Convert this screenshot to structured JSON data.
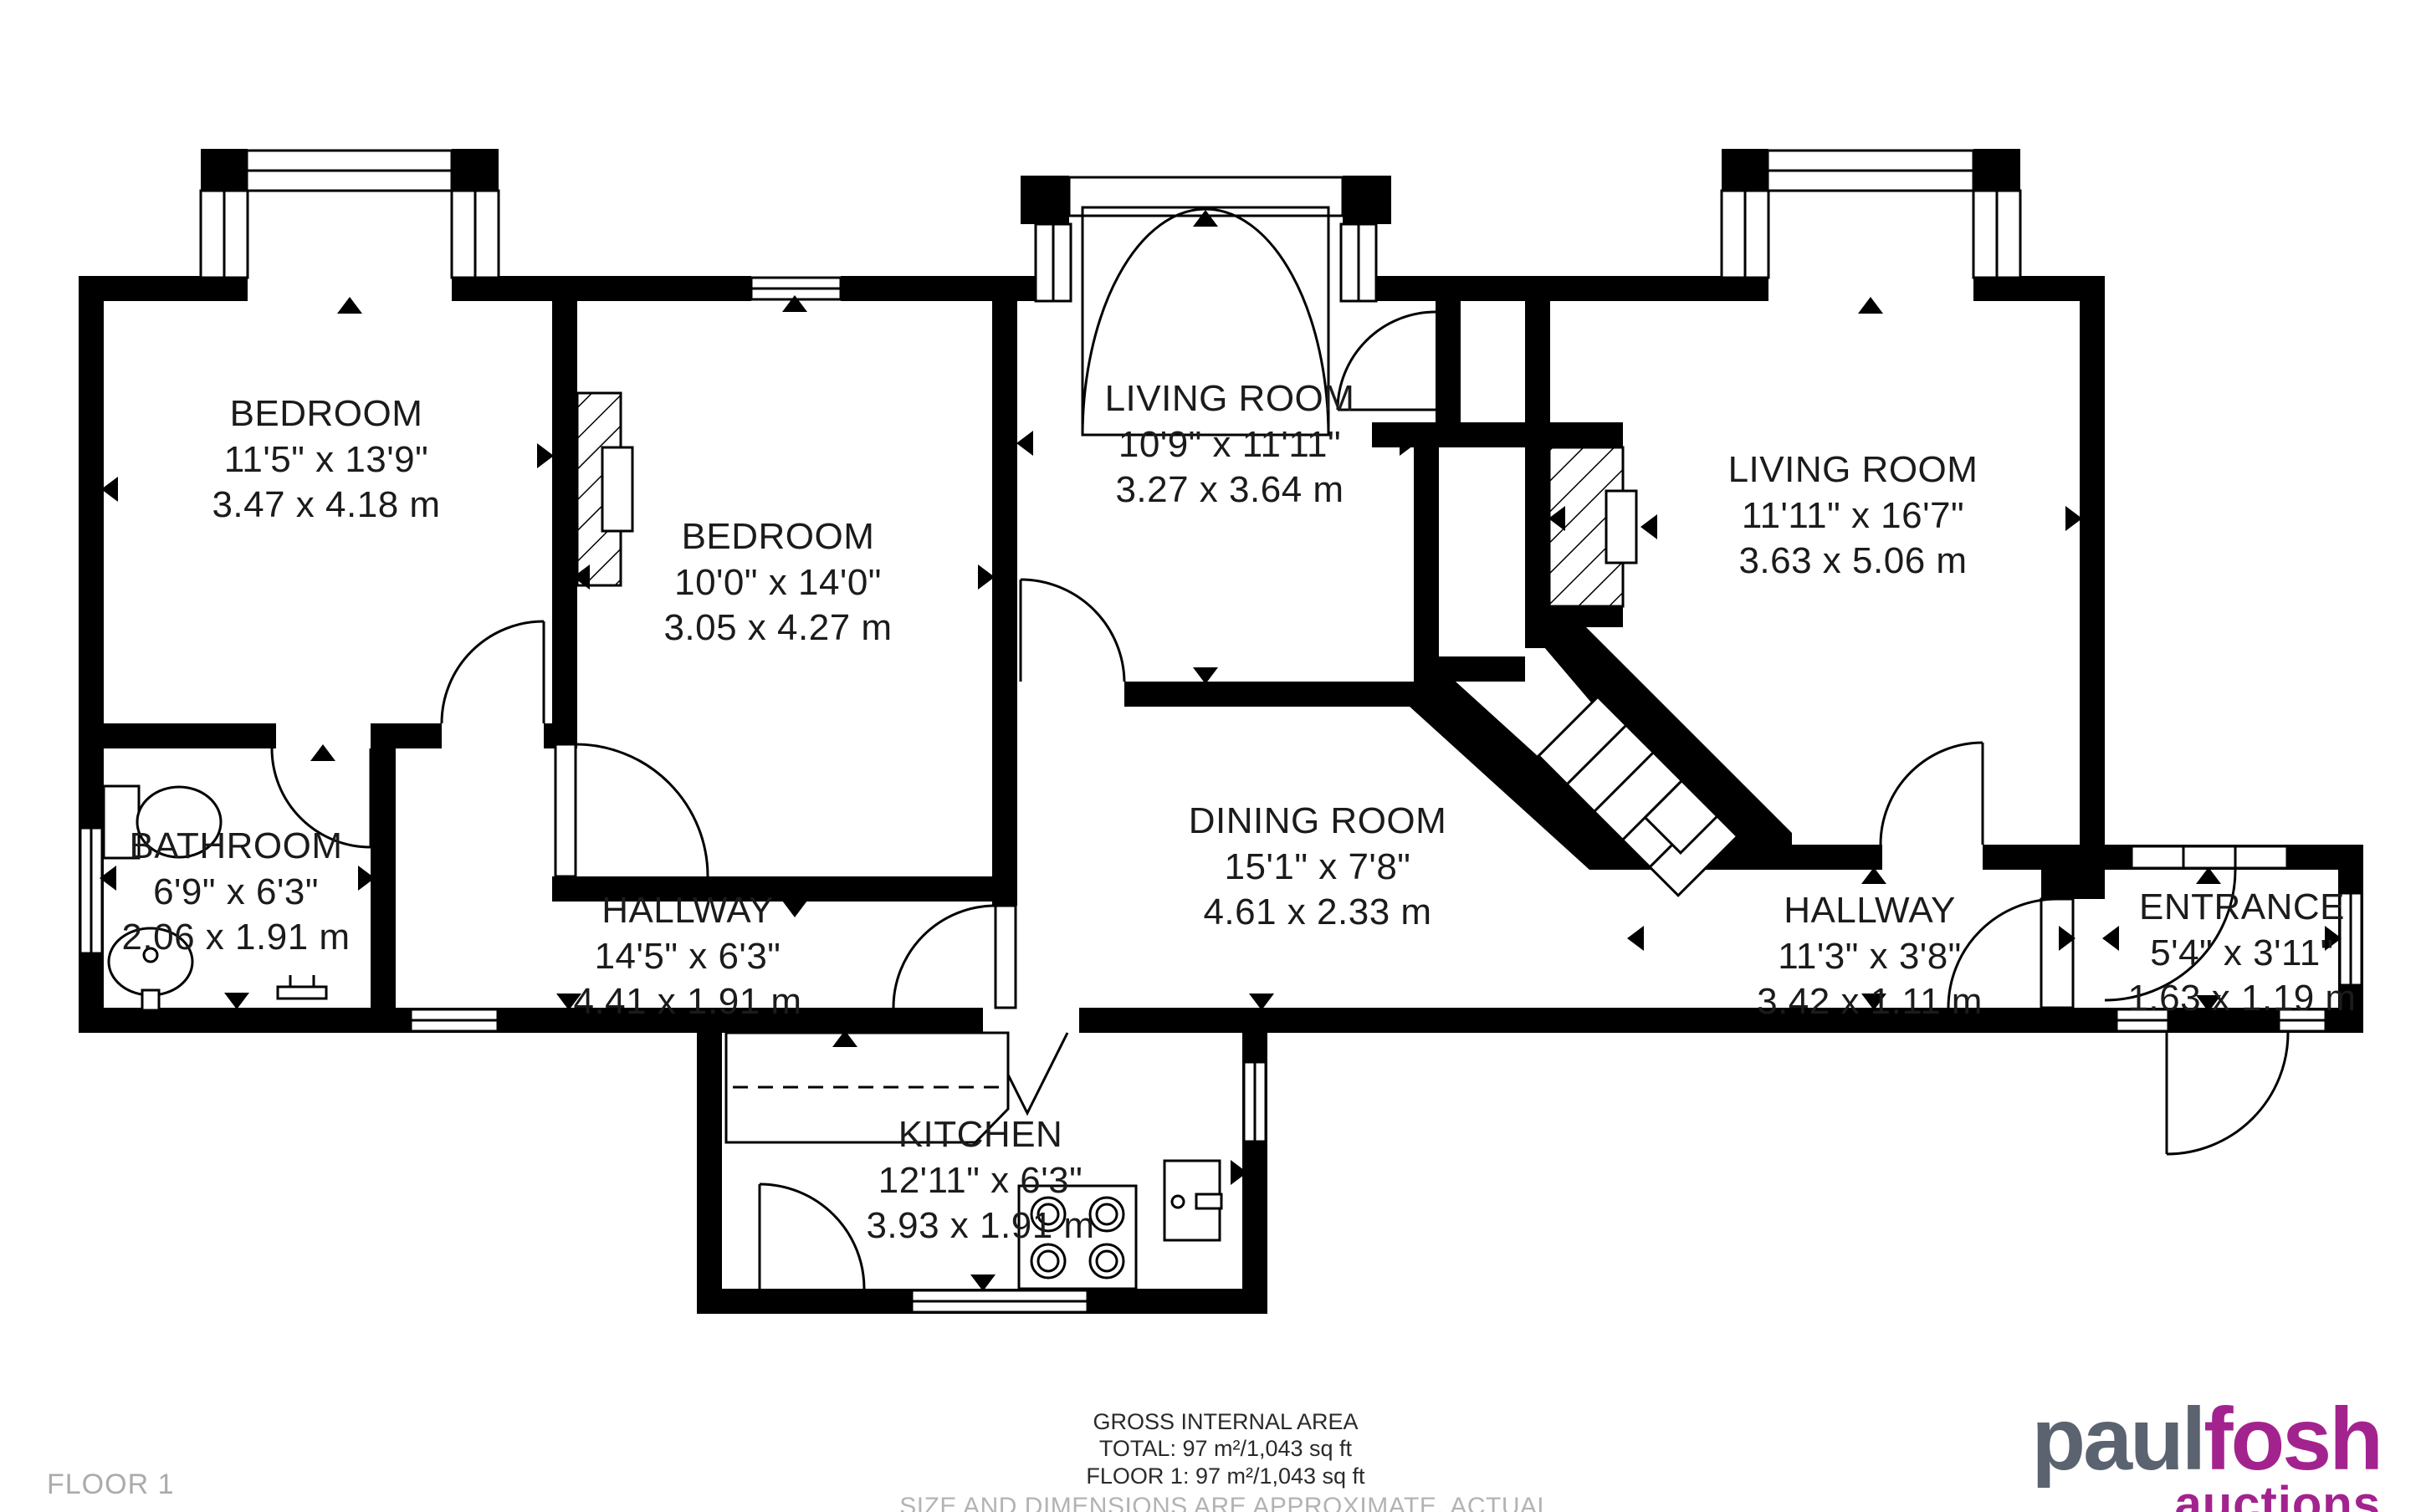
{
  "rooms": {
    "bedroom1": {
      "name": "BEDROOM",
      "imperial": "11'5\" x 13'9\"",
      "metric": "3.47 x 4.18 m"
    },
    "bedroom2": {
      "name": "BEDROOM",
      "imperial": "10'0\" x 14'0\"",
      "metric": "3.05 x 4.27 m"
    },
    "living1": {
      "name": "LIVING ROOM",
      "imperial": "10'9\" x 11'11\"",
      "metric": "3.27 x 3.64 m"
    },
    "living2": {
      "name": "LIVING ROOM",
      "imperial": "11'11\" x 16'7\"",
      "metric": "3.63 x 5.06 m"
    },
    "bathroom": {
      "name": "BATHROOM",
      "imperial": "6'9\" x 6'3\"",
      "metric": "2.06 x 1.91 m"
    },
    "hallway1": {
      "name": "HALLWAY",
      "imperial": "14'5\" x 6'3\"",
      "metric": "4.41 x 1.91 m"
    },
    "dining": {
      "name": "DINING ROOM",
      "imperial": "15'1\" x 7'8\"",
      "metric": "4.61 x 2.33 m"
    },
    "hallway2": {
      "name": "HALLWAY",
      "imperial": "11'3\" x 3'8\"",
      "metric": "3.42 x 1.11 m"
    },
    "entrance": {
      "name": "ENTRANCE",
      "imperial": "5'4\" x 3'11\"",
      "metric": "1.63 x 1.19 m"
    },
    "kitchen": {
      "name": "KITCHEN",
      "imperial": "12'11\" x 6'3\"",
      "metric": "3.93 x 1.91 m"
    }
  },
  "footer": {
    "gross": "GROSS INTERNAL AREA",
    "total": "TOTAL: 97 m²/1,043 sq ft",
    "floor": "FLOOR 1: 97 m²/1,043 sq ft",
    "disclaimer": "SIZE AND DIMENSIONS ARE APPROXIMATE, ACTUAL MAY VARY",
    "floor_label": "FLOOR 1"
  },
  "logo": {
    "part1": "paul",
    "part2": "fosh",
    "tagline": "auctions",
    "color_gray": "#5b6370",
    "color_purple": "#a3238e"
  },
  "colors": {
    "wall": "#000000",
    "text": "#1b1b1b",
    "muted": "#b3b3b3"
  }
}
